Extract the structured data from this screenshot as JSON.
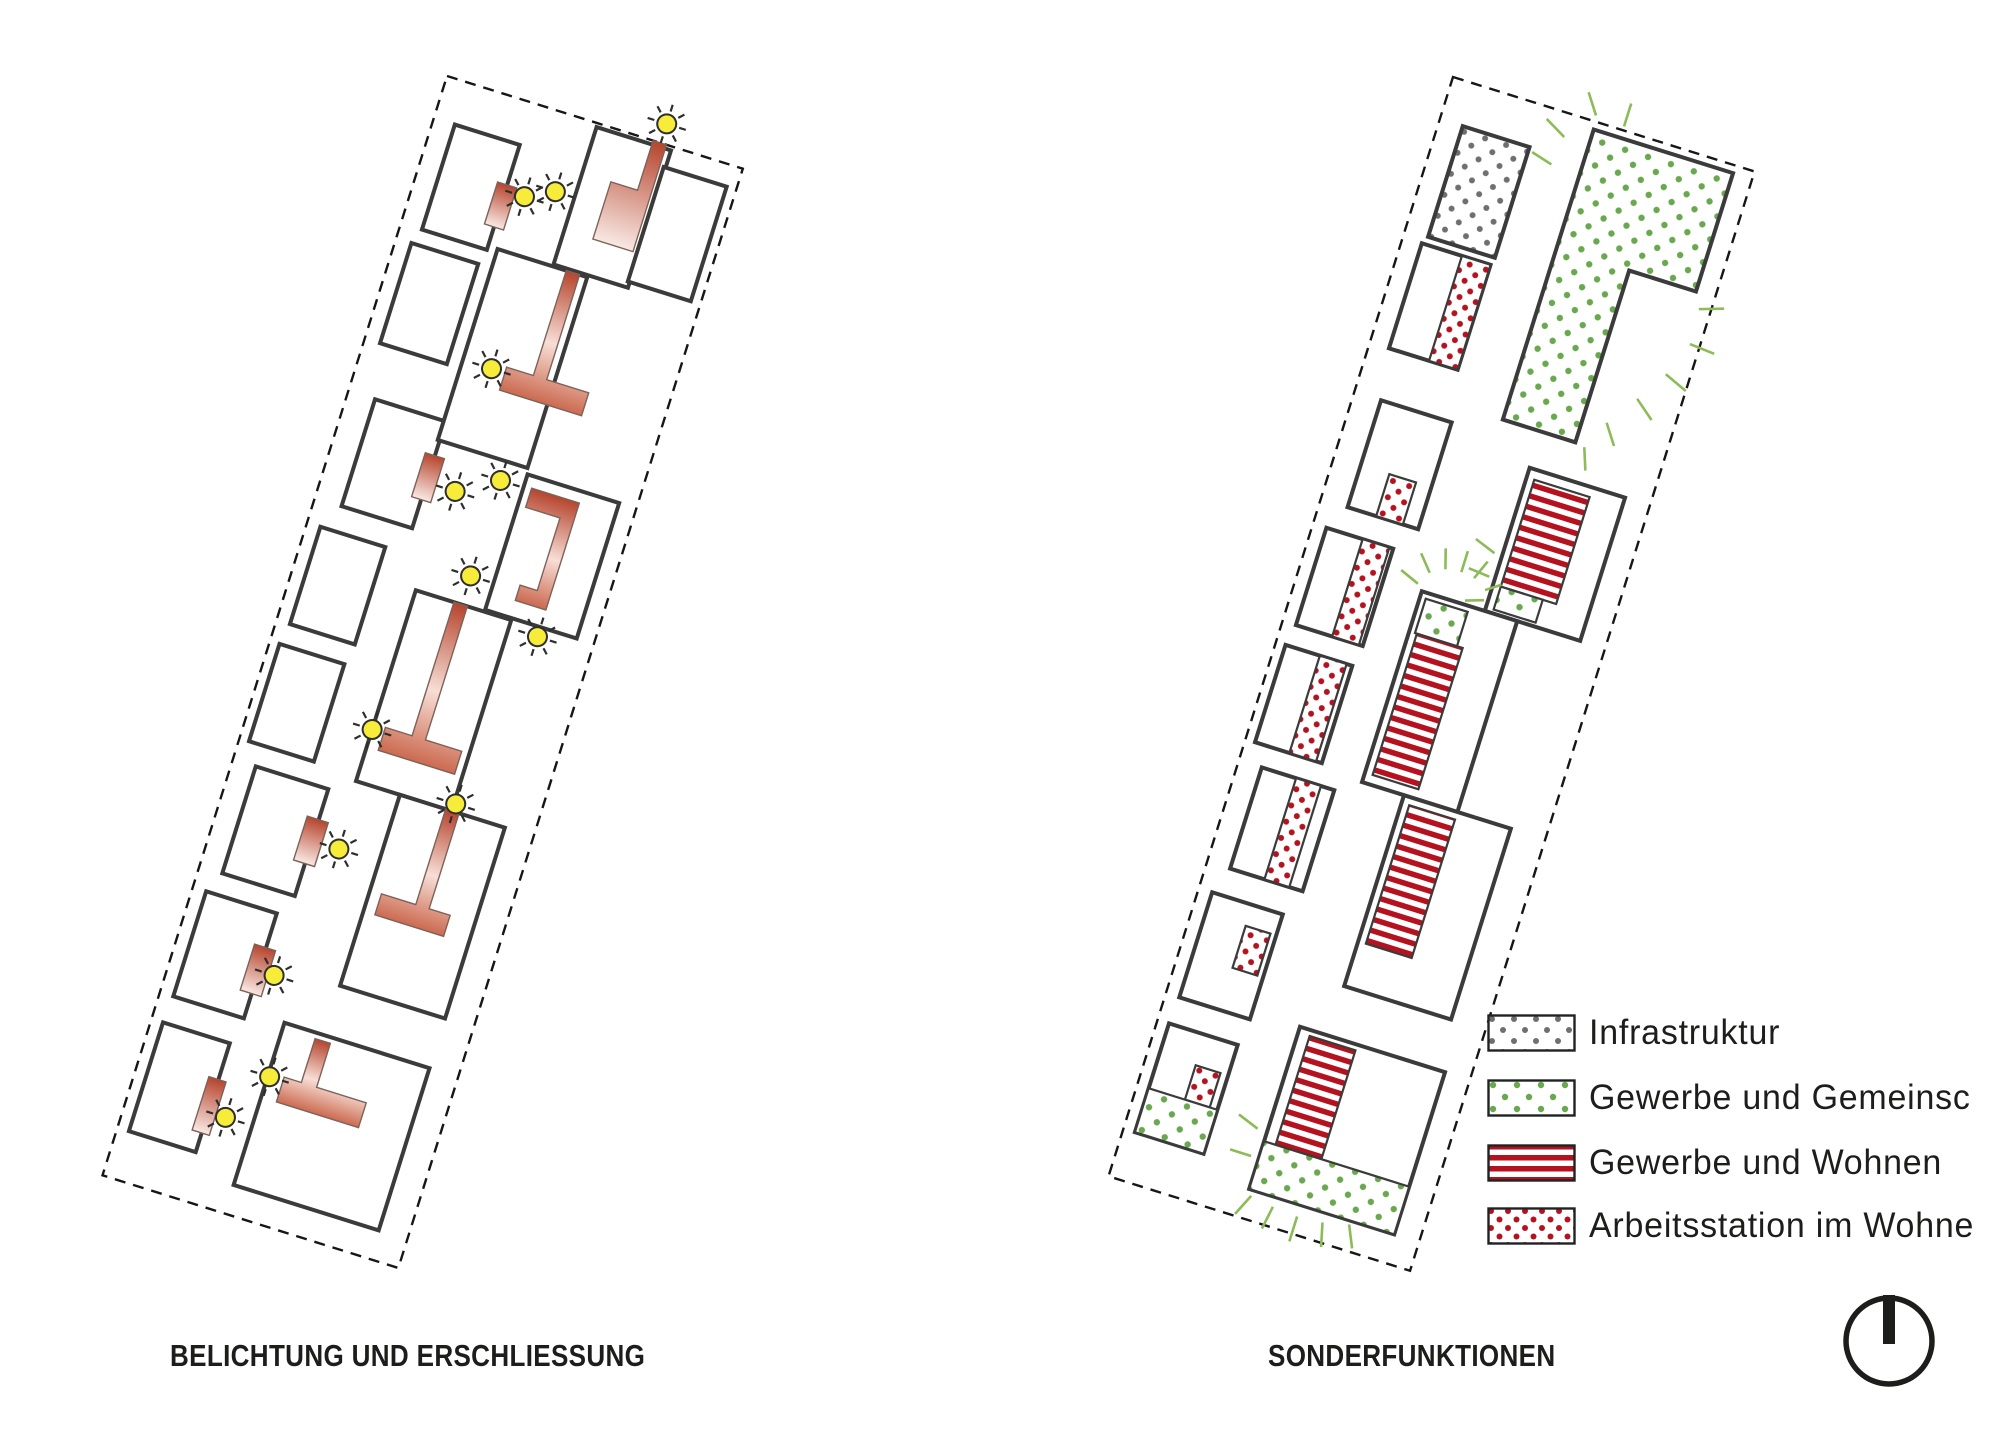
{
  "diagrams": {
    "left": {
      "title": "BELICHTUNG UND ERSCHLIESSUNG",
      "sun_count": 14
    },
    "right": {
      "title": "SONDERFUNKTIONEN"
    }
  },
  "legend": {
    "items": [
      {
        "label": "Infrastruktur",
        "swatch": "gray-dots",
        "color": "#6f6f6f"
      },
      {
        "label": "Gewerbe und Gemeinsc",
        "swatch": "green-dots",
        "color": "#6aa84f"
      },
      {
        "label": "Gewerbe und Wohnen",
        "swatch": "red-stripes",
        "color": "#b5121f"
      },
      {
        "label": "Arbeitsstation im Wohne",
        "swatch": "red-dots",
        "color": "#b5121f"
      }
    ]
  },
  "colors": {
    "building_outline": "#3b3b3b",
    "boundary_dash": "#161616",
    "sun_fill": "#f7ec3a",
    "sun_stroke": "#2e2e2e",
    "circulation_red": "#b6452e",
    "circulation_pale": "#f9e9e4",
    "stripe_red": "#b5121f",
    "dot_red": "#b5121f",
    "dot_green": "#6aa84f",
    "dot_gray": "#6f6f6f",
    "ray_green": "#8cbb57",
    "text": "#1d1d1b",
    "north_icon": "#1d1d1b"
  },
  "icons": {
    "sun": "sun-icon",
    "north": "north-indicator"
  }
}
